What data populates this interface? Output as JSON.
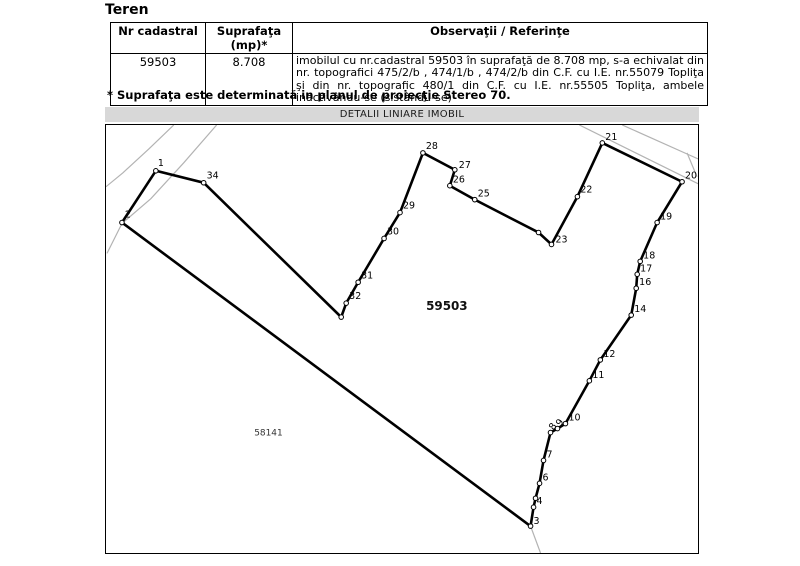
{
  "title": "Teren",
  "table": {
    "headers": [
      "Nr cadastral",
      "Suprafaţa (mp)*",
      "Observaţii / Referinţe"
    ],
    "row": {
      "nr_cadastral": "59503",
      "suprafata": "8.708",
      "observatii": "imobilul cu nr.cadastral 59503 în suprafaţă de 8.708 mp, s-a echivalat din nr. topografici 475/2/b , 474/1/b , 474/2/b din C.F. cu I.E. nr.55079 Topliţa şi din nr. topografic 480/1 din C.F. cu I.E. nr.55505 Topliţa, ambele inactivându-se (sistându-se)"
    }
  },
  "footnote": "* Suprafaţa este determinată in planul de proiecţie Stereo 70.",
  "map": {
    "title": "DETALII LINIARE IMOBIL",
    "colors": {
      "road": "#b3b3b3",
      "boundary": "#000000",
      "bar_bg": "#d8d8d8"
    },
    "parcel_label": {
      "text": "59503",
      "x": 447,
      "y": 310
    },
    "neighbor_label": {
      "text": "58141",
      "x": 268,
      "y": 436
    },
    "roads": [
      [
        [
          173,
          124
        ],
        [
          148,
          148
        ],
        [
          122,
          172
        ],
        [
          105,
          186
        ]
      ],
      [
        [
          216,
          124
        ],
        [
          183,
          162
        ],
        [
          150,
          198
        ],
        [
          121,
          223
        ],
        [
          106,
          253
        ]
      ],
      [
        [
          580,
          124
        ],
        [
          699,
          183
        ]
      ],
      [
        [
          623,
          124
        ],
        [
          699,
          158
        ]
      ],
      [
        [
          688,
          152
        ],
        [
          698,
          176
        ]
      ],
      [
        [
          531,
          527
        ],
        [
          541,
          554
        ]
      ]
    ],
    "vertices": [
      {
        "n": "1",
        "x": 155,
        "y": 170,
        "label": true,
        "dx": 2,
        "dy": -5,
        "rot": 0
      },
      {
        "n": "2",
        "x": 121,
        "y": 222,
        "label": true,
        "dx": 3,
        "dy": -5,
        "rot": 0
      },
      {
        "n": "3",
        "x": 531,
        "y": 527,
        "label": true,
        "dx": 3,
        "dy": -2,
        "rot": 0
      },
      {
        "n": "4",
        "x": 534,
        "y": 508,
        "label": true,
        "dx": 3,
        "dy": -3,
        "rot": 0
      },
      {
        "n": "5",
        "x": 536,
        "y": 499,
        "label": false,
        "dx": 0,
        "dy": 0,
        "rot": 0
      },
      {
        "n": "6",
        "x": 540,
        "y": 484,
        "label": true,
        "dx": 3,
        "dy": -3,
        "rot": 0
      },
      {
        "n": "7",
        "x": 544,
        "y": 461,
        "label": true,
        "dx": 3,
        "dy": -3,
        "rot": 0
      },
      {
        "n": "8",
        "x": 551,
        "y": 433,
        "label": true,
        "dx": 3,
        "dy": -2,
        "rot": -55
      },
      {
        "n": "9",
        "x": 558,
        "y": 429,
        "label": true,
        "dx": 3,
        "dy": -2,
        "rot": -55
      },
      {
        "n": "10",
        "x": 566,
        "y": 424,
        "label": true,
        "dx": 3,
        "dy": -3,
        "rot": 0
      },
      {
        "n": "11",
        "x": 590,
        "y": 381,
        "label": true,
        "dx": 3,
        "dy": -3,
        "rot": 0
      },
      {
        "n": "12",
        "x": 601,
        "y": 360,
        "label": true,
        "dx": 3,
        "dy": -3,
        "rot": 0
      },
      {
        "n": "14",
        "x": 632,
        "y": 315,
        "label": true,
        "dx": 3,
        "dy": -3,
        "rot": 0
      },
      {
        "n": "16",
        "x": 637,
        "y": 288,
        "label": true,
        "dx": 3,
        "dy": -3,
        "rot": 0
      },
      {
        "n": "17",
        "x": 638,
        "y": 274,
        "label": true,
        "dx": 3,
        "dy": -3,
        "rot": 0
      },
      {
        "n": "18",
        "x": 641,
        "y": 261,
        "label": true,
        "dx": 3,
        "dy": -3,
        "rot": 0
      },
      {
        "n": "19",
        "x": 658,
        "y": 222,
        "label": true,
        "dx": 3,
        "dy": -3,
        "rot": 0
      },
      {
        "n": "20",
        "x": 683,
        "y": 181,
        "label": true,
        "dx": 3,
        "dy": -3,
        "rot": 0
      },
      {
        "n": "21",
        "x": 603,
        "y": 142,
        "label": true,
        "dx": 3,
        "dy": -3,
        "rot": 0
      },
      {
        "n": "22",
        "x": 578,
        "y": 196,
        "label": true,
        "dx": 3,
        "dy": -4,
        "rot": 0
      },
      {
        "n": "23",
        "x": 552,
        "y": 244,
        "label": true,
        "dx": 4,
        "dy": -2,
        "rot": 0
      },
      {
        "n": "24",
        "x": 539,
        "y": 232,
        "label": false,
        "dx": 0,
        "dy": 0,
        "rot": 0
      },
      {
        "n": "25",
        "x": 475,
        "y": 199,
        "label": true,
        "dx": 3,
        "dy": -3,
        "rot": 0
      },
      {
        "n": "26",
        "x": 450,
        "y": 185,
        "label": true,
        "dx": 3,
        "dy": -3,
        "rot": 0
      },
      {
        "n": "27",
        "x": 455,
        "y": 169,
        "label": true,
        "dx": 4,
        "dy": -2,
        "rot": 0
      },
      {
        "n": "28",
        "x": 423,
        "y": 152,
        "label": true,
        "dx": 3,
        "dy": -4,
        "rot": 0
      },
      {
        "n": "29",
        "x": 400,
        "y": 212,
        "label": true,
        "dx": 3,
        "dy": -4,
        "rot": 0
      },
      {
        "n": "30",
        "x": 384,
        "y": 238,
        "label": true,
        "dx": 3,
        "dy": -4,
        "rot": 0
      },
      {
        "n": "31",
        "x": 358,
        "y": 282,
        "label": true,
        "dx": 3,
        "dy": -4,
        "rot": 0
      },
      {
        "n": "32",
        "x": 346,
        "y": 303,
        "label": true,
        "dx": 3,
        "dy": -4,
        "rot": 0
      },
      {
        "n": "33",
        "x": 341,
        "y": 317,
        "label": false,
        "dx": 0,
        "dy": 0,
        "rot": 0
      },
      {
        "n": "34",
        "x": 203,
        "y": 182,
        "label": true,
        "dx": 3,
        "dy": -4,
        "rot": 0
      }
    ]
  }
}
